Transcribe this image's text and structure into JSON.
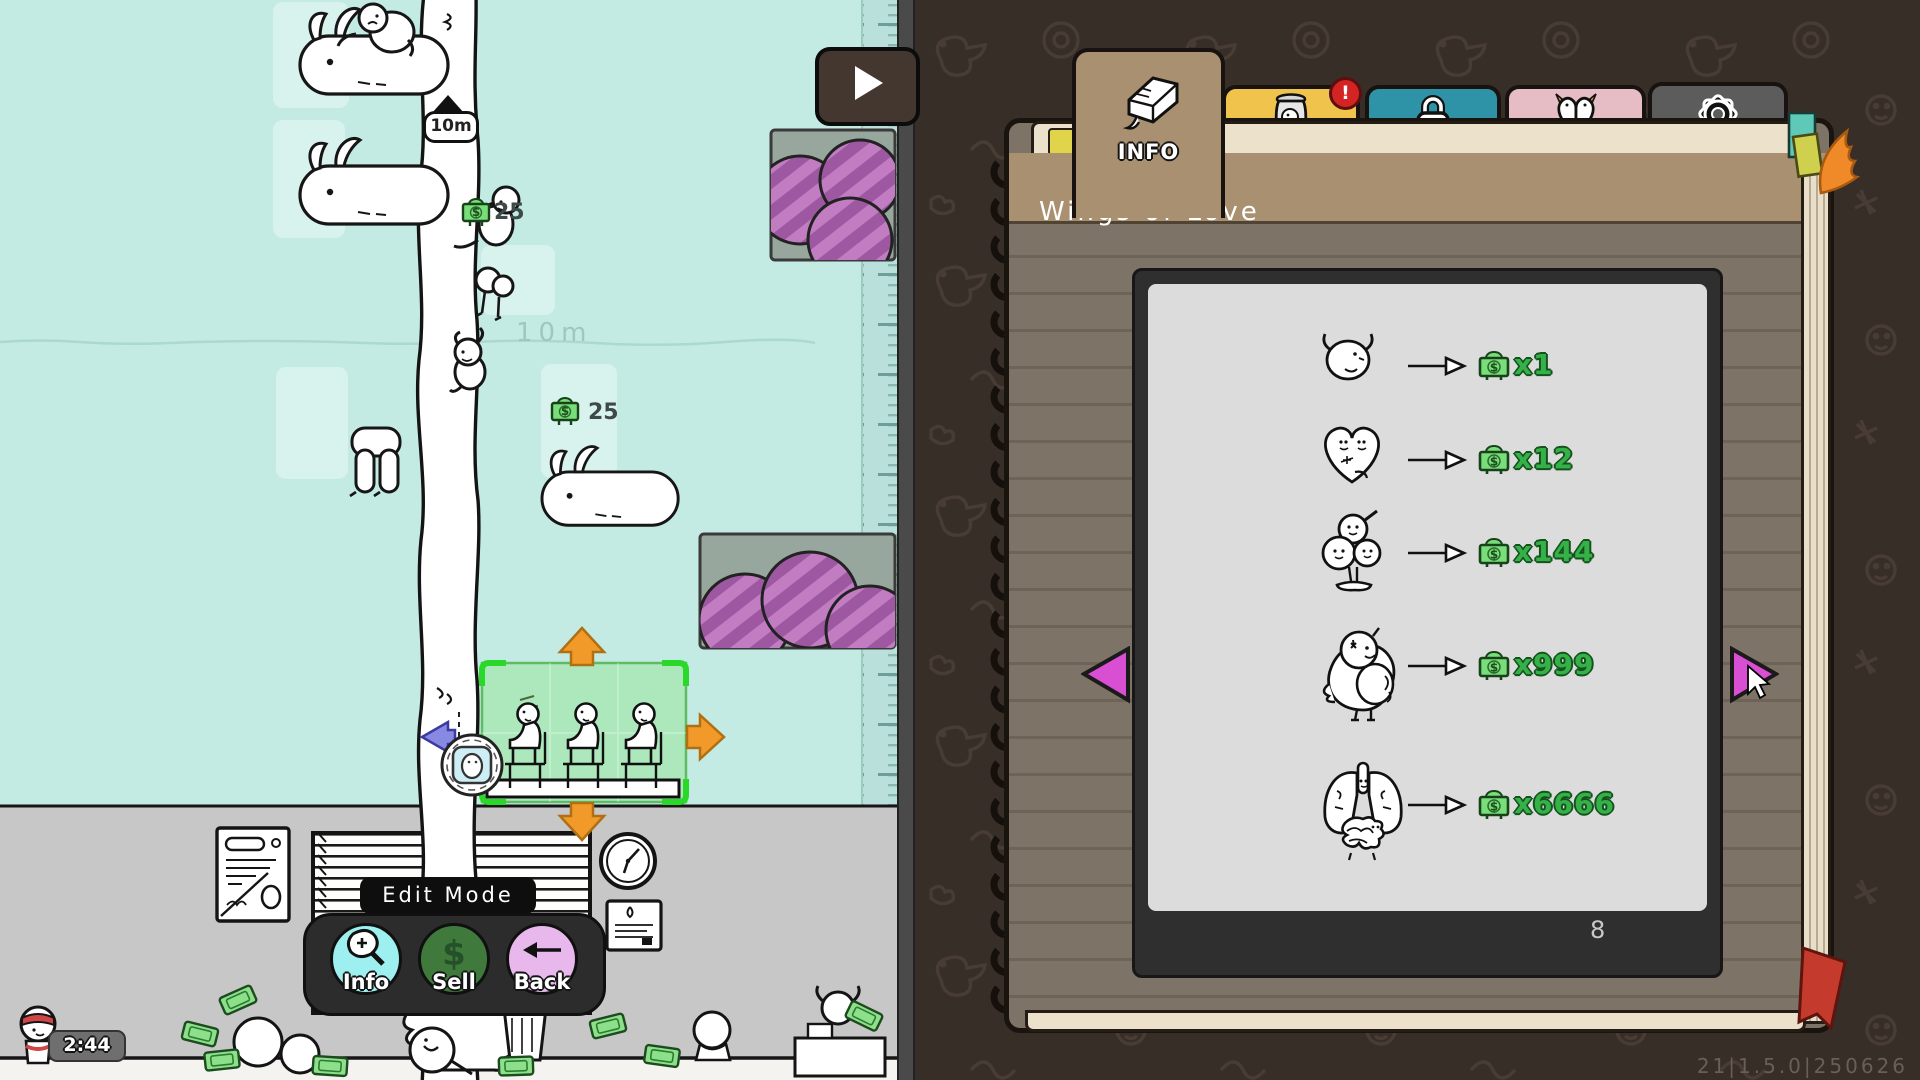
{
  "icons": {
    "dollar": "$"
  },
  "left": {
    "flag_label": "10m",
    "depth_label": "10m",
    "money_markers": [
      "25",
      "25"
    ],
    "timer": "2:44",
    "edit_mode": {
      "title": "Edit Mode",
      "buttons": [
        {
          "label": "Info",
          "icon": "magnifier-icon"
        },
        {
          "label": "Sell",
          "icon": "dollar-icon"
        },
        {
          "label": "Back",
          "icon": "back-arrow-icon"
        }
      ]
    },
    "colors": {
      "sky": "#c3ebe4",
      "wall": "#c7c7c7",
      "selection_green": "#2ad82a",
      "arrow_orange": "#f19a2a"
    }
  },
  "right": {
    "tabs": [
      {
        "label": "INFO",
        "icon": "book-icon",
        "active": true
      },
      {
        "label": "DNA",
        "icon": "jar-icon",
        "notification": "!"
      },
      {
        "label": "Unlock",
        "icon": "lock-icon"
      },
      {
        "label": "STATS",
        "icon": "bird-heart-icon"
      },
      {
        "label": "CONFIG",
        "icon": "gear-icon"
      }
    ],
    "notebook": {
      "title": "Wings of Love",
      "page_number": "8",
      "rows": [
        {
          "creature": "chick-stage-1",
          "multiplier": "x1"
        },
        {
          "creature": "heart-stage-2",
          "multiplier": "x12"
        },
        {
          "creature": "triple-stage-3",
          "multiplier": "x144"
        },
        {
          "creature": "bird-stage-4",
          "multiplier": "x999"
        },
        {
          "creature": "lungs-stage-5",
          "multiplier": "x6666"
        }
      ]
    },
    "version": "21|1.5.0|250626",
    "colors": {
      "cover": "#7d7366",
      "tab_dna": "#f0c44c",
      "tab_unlock": "#2f93a7",
      "tab_stats": "#e6bdc4",
      "tab_config": "#5c5c5c",
      "money_green": "#35b148",
      "nav_pink": "#d94fd4"
    }
  }
}
